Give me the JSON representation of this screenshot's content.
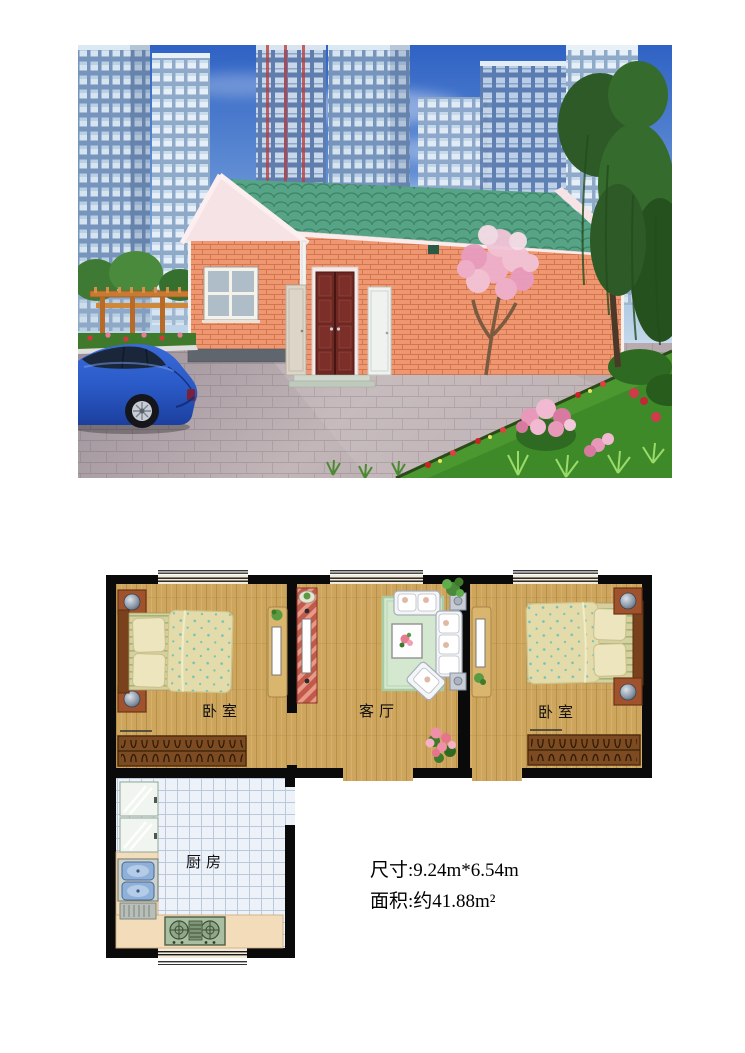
{
  "page": {
    "background": "#ffffff"
  },
  "photo": {
    "name": "house-exterior-rendering",
    "colors": {
      "sky": "#3b6fd0",
      "roof_green": "#57a385",
      "brick_salmon": "#ee9770",
      "gable_pink": "#f6e3e6",
      "door_red": "#6e2722",
      "sedan_blue": "#2b5bc8",
      "suv_teal": "#2f9aa0",
      "foliage_green": "#3f7a2c",
      "blossom_pink": "#f2b9d3",
      "pavement_gray": "#a79aa2"
    }
  },
  "floorplan": {
    "rooms": [
      {
        "id": "bedroom-left",
        "label": "卧室"
      },
      {
        "id": "living-room",
        "label": "客厅"
      },
      {
        "id": "bedroom-right",
        "label": "卧室"
      },
      {
        "id": "kitchen",
        "label": "厨房"
      }
    ],
    "colors": {
      "wall": "#0a0a0a",
      "wood_floor": "#cda55d",
      "kitchen_tile": "#edf1f8",
      "rug_green": "#d4e7cf",
      "wardrobe_brown": "#7d4b22",
      "counter_tan": "#f2dcba"
    }
  },
  "info": {
    "dimensions_line": "尺寸:9.24m*6.54m",
    "area_line": "面积:约41.88m²"
  }
}
